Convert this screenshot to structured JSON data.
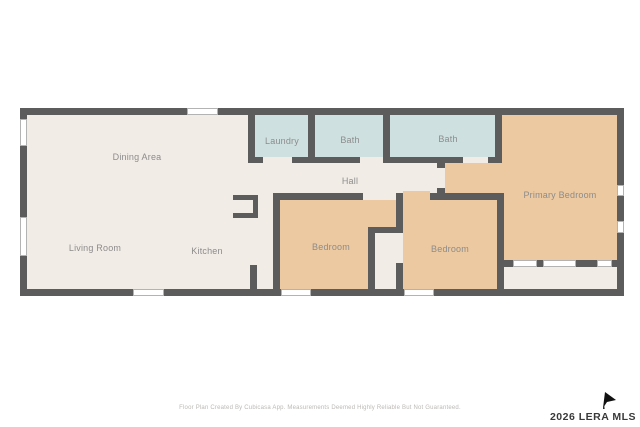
{
  "rooms": {
    "dining_area": {
      "label": "Dining Area"
    },
    "living_room": {
      "label": "Living Room"
    },
    "kitchen": {
      "label": "Kitchen"
    },
    "laundry": {
      "label": "Laundry"
    },
    "bath_1": {
      "label": "Bath"
    },
    "bath_2": {
      "label": "Bath"
    },
    "hall": {
      "label": "Hall"
    },
    "bedroom_1": {
      "label": "Bedroom"
    },
    "bedroom_2": {
      "label": "Bedroom"
    },
    "primary_bedroom": {
      "label": "Primary Bedroom"
    }
  },
  "footer": {
    "disclaimer": "Floor Plan Created By Cubicasa App. Measurements Deemed Highly Reliable But Not Guaranteed."
  },
  "watermark": {
    "text": "2026 LERA MLS"
  },
  "colors": {
    "wall": "#5c5c5c",
    "floor": "#f2ece6",
    "bedroom_fill": "#ecc9a0",
    "bath_fill": "#cfe0e0",
    "label_text": "#8c8c8c",
    "watermark_text": "#3a3a3a"
  }
}
